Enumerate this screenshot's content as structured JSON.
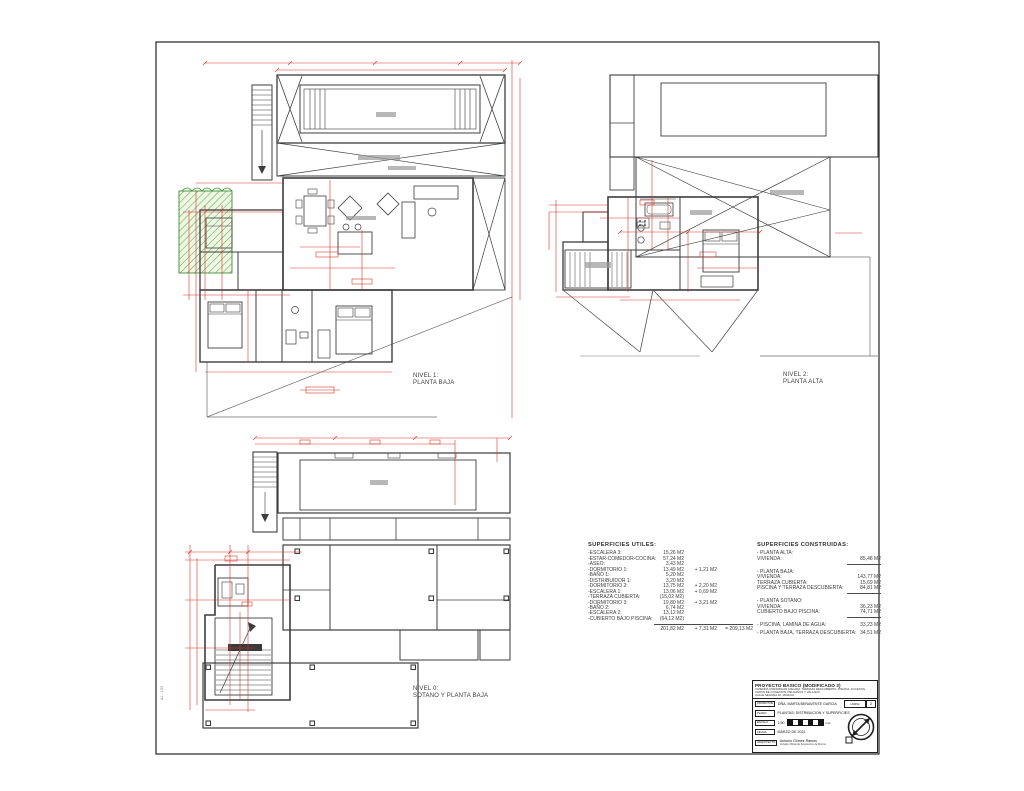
{
  "plans": {
    "nivel1": {
      "line1": "NIVEL 1:",
      "line2": "PLANTA BAJA"
    },
    "nivel2": {
      "line1": "NIVEL 2:",
      "line2": "PLANTA ALTA"
    },
    "nivel0": {
      "line1": "NIVEL 0:",
      "line2": "SOTANO Y PLANTA BAJA"
    }
  },
  "utiles": {
    "title": "SUPERFICIES UTILES:",
    "rows": [
      {
        "name": "-ESCALERA 3:",
        "value": "15,26 M2",
        "extra": ""
      },
      {
        "name": "-ESTAR-COMEDOR-COCINA:",
        "value": "57,24 M2",
        "extra": ""
      },
      {
        "name": "-ASEO:",
        "value": "3,43 M2",
        "extra": ""
      },
      {
        "name": "-DORMITORIO 1:",
        "value": "13,49 M2",
        "extra": "+ 1,21 M2"
      },
      {
        "name": "-BAÑO 1:",
        "value": "5,20 M2",
        "extra": ""
      },
      {
        "name": "-DISTRIBUIDOR 1:",
        "value": "3,20 M2",
        "extra": ""
      },
      {
        "name": "-DORMITORIO 2:",
        "value": "13,75 M2",
        "extra": "+ 2,20 M2"
      },
      {
        "name": "-ESCALERA 1:",
        "value": "13,06 M2",
        "extra": "+ 0,69 M2"
      },
      {
        "name": "-TERRAZA CUBIERTA:",
        "value": "(15,02 M2)",
        "extra": ""
      },
      {
        "name": "-DORMITORIO 3:",
        "value": "19,80 M2",
        "extra": "+ 3,21 M2"
      },
      {
        "name": "-BAÑO 2:",
        "value": "6,74 M2",
        "extra": ""
      },
      {
        "name": "-ESCALERA 2:",
        "value": "13,12 M2",
        "extra": ""
      },
      {
        "name": "-CUBIERTO BAJO PISCINA:",
        "value": "(64,12 M2)",
        "extra": ""
      }
    ],
    "total_value": "201,82 M2",
    "total_extra": "+ 7,31 M2",
    "total_sum": "= 209,13 M2"
  },
  "construidas": {
    "title": "SUPERFICIES CONSTRUIDAS:",
    "groups": [
      {
        "heading": "- PLANTA ALTA:",
        "rows": [
          {
            "name": "VIVIENDA:",
            "value": "85,48 M2"
          }
        ]
      },
      {
        "heading": "- PLANTA BAJA:",
        "rows": [
          {
            "name": "VIVIENDA:",
            "value": "143,77 M2"
          },
          {
            "name": "TERRAZA CUBIERTA:",
            "value": "15,69 M2"
          },
          {
            "name": "PISCINA Y TERRAZA DESCUBIERTA:",
            "value": "84,81 M2"
          }
        ]
      },
      {
        "heading": "- PLANTA SOTANO:",
        "rows": [
          {
            "name": "VIVIENDA:",
            "value": "36,23 M2"
          },
          {
            "name": "CUBIERTO BAJO PISCINA:",
            "value": "74,71 M2"
          }
        ]
      }
    ],
    "extra1": {
      "name": "- PISCINA, LAMINA DE AGUA:",
      "value": "33,23 M2"
    },
    "extra2": {
      "name": "- PLANTA BAJA, TERRAZA DESCUBIERTA:",
      "value": "34,51 M2"
    }
  },
  "title_block": {
    "title": "PROYECTO BASICO (MODIFICADO 2)",
    "desc1": "VIVIENDA UNIFAMILIAR AISLADA, TERRAZA DESCUBIERTA, PISCINA, ACCESOS,",
    "desc2": "VADOS DE CONEXION, PELDAÑOS Y VALLADO",
    "desc3": "CALLE SEGURA 10, MURCIA",
    "rows": [
      {
        "label": "PROMOTOR",
        "value": "DÑA. MARTA BENAVENTE GARCIA"
      },
      {
        "label": "PLANO",
        "value": "PLANTAS: DISTRIBUCION Y SUPERFICIES"
      },
      {
        "label": "ESCALA",
        "value": "1:50"
      },
      {
        "label": "FECHA",
        "value": "MARZO DE 2021"
      },
      {
        "label": "ARQUITECTO",
        "value": "Antonio Gómez Ramos"
      }
    ],
    "architect_sub": "Colegio Oficial de Arquitectos de Murcia",
    "scale_units": "mts",
    "lamina_label": "LAMINA",
    "sheet_number": "2"
  },
  "side_stamp": "A1 - 1:50",
  "colors": {
    "walls": "#3d3d3d",
    "dimensions": "#d9342b",
    "landscape": "#5fae3f"
  }
}
